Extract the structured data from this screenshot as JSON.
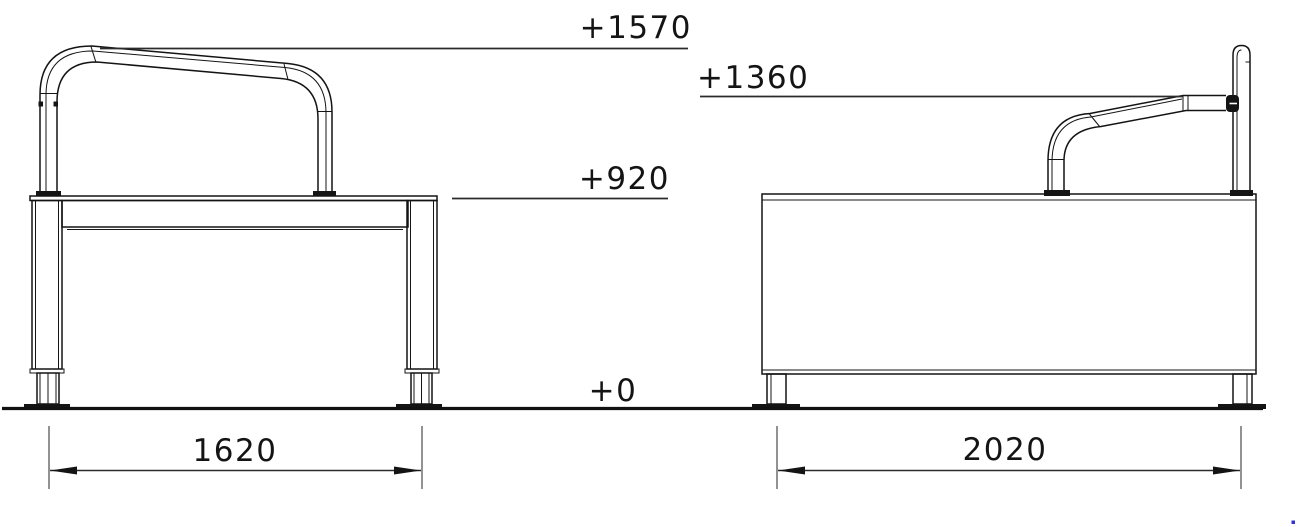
{
  "drawing": {
    "type": "technical-elevation-drawing",
    "background": "#ffffff",
    "line_color": "#141414",
    "cursor_dot_color": "#3333cc"
  },
  "levels": {
    "l1570": "+1570",
    "l1360": "+1360",
    "l920": "+920",
    "l0": "+0"
  },
  "dims": {
    "front_width": "1620",
    "side_width": "2020"
  }
}
